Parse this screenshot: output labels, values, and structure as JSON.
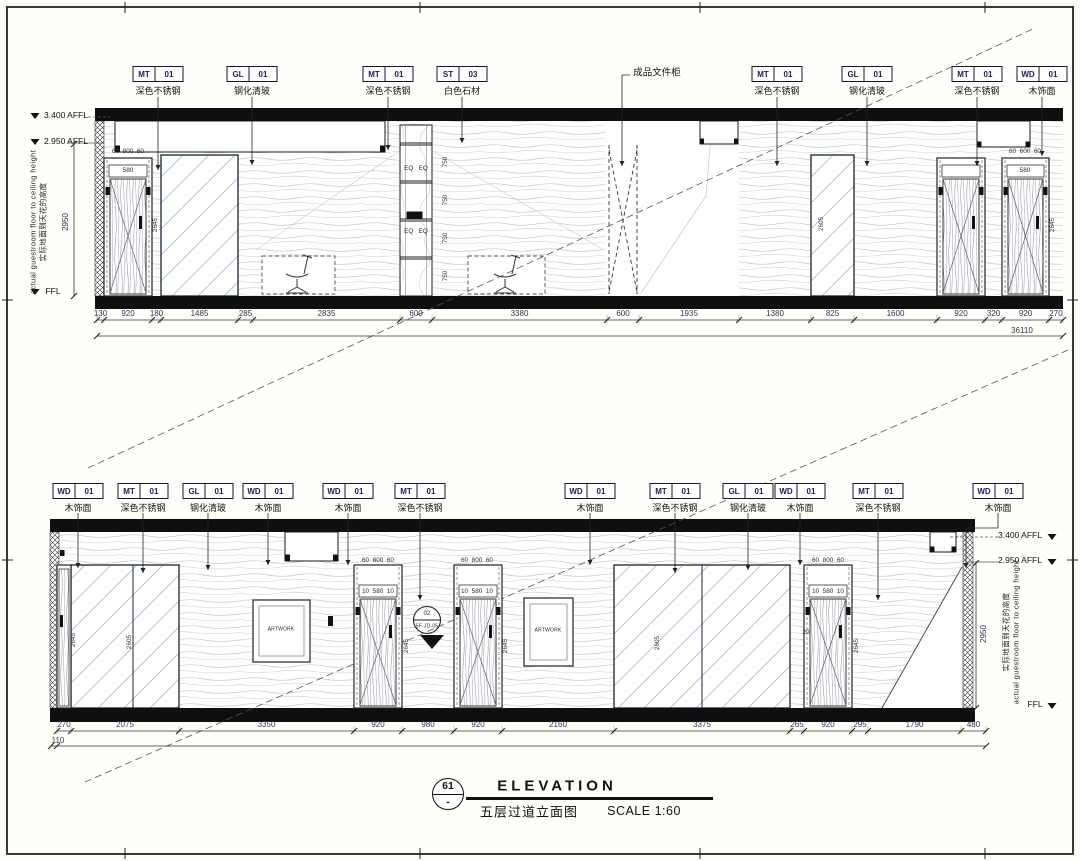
{
  "drawing": {
    "title_block": {
      "detail_number": "61",
      "detail_ref": "-",
      "title": "ELEVATION",
      "name_cn": "五层过道立面图",
      "scale": "SCALE 1:60"
    },
    "levels": {
      "afl_340": "3.400 AFFL",
      "afl_295": "2.950 AFFL",
      "ffl": "FFL",
      "floor_to_ceiling": "2950",
      "note_en": "actual guestroom floor to ceiling height",
      "note_cn": "实际地面到天花的高度"
    },
    "top_elevation": {
      "tags": [
        {
          "code": "MT",
          "num": "01",
          "desc": "深色不锈钢"
        },
        {
          "code": "GL",
          "num": "01",
          "desc": "钢化清玻"
        },
        {
          "code": "MT",
          "num": "01",
          "desc": "深色不锈钢"
        },
        {
          "code": "ST",
          "num": "03",
          "desc": "白色石材"
        },
        {
          "code": "MT",
          "num": "01",
          "desc": "深色不锈钢"
        },
        {
          "code": "GL",
          "num": "01",
          "desc": "钢化清玻"
        },
        {
          "code": "MT",
          "num": "01",
          "desc": "深色不锈钢"
        },
        {
          "code": "WD",
          "num": "01",
          "desc": "木饰面"
        }
      ],
      "cabinet_note": "成品文件柜",
      "dims": [
        "130",
        "920",
        "180",
        "1485",
        "285",
        "2835",
        "600",
        "3380",
        "600",
        "1935",
        "1380",
        "825",
        "1600",
        "920",
        "320",
        "920",
        "270"
      ],
      "overall_dim": "36110",
      "micro_dims": {
        "door_frame": "60  800  60",
        "door_frame_r": "60  600  60",
        "door_leaf": "580",
        "shelf_eq": "EQ   EQ",
        "shelf_h": "750",
        "door_h": "2645",
        "glass_h": "2605"
      }
    },
    "bottom_elevation": {
      "tags": [
        {
          "code": "WD",
          "num": "01",
          "desc": "木饰面"
        },
        {
          "code": "MT",
          "num": "01",
          "desc": "深色不锈钢"
        },
        {
          "code": "GL",
          "num": "01",
          "desc": "钢化清玻"
        },
        {
          "code": "WD",
          "num": "01",
          "desc": "木饰面"
        },
        {
          "code": "WD",
          "num": "01",
          "desc": "木饰面"
        },
        {
          "code": "MT",
          "num": "01",
          "desc": "深色不锈钢"
        },
        {
          "code": "WD",
          "num": "01",
          "desc": "木饰面"
        },
        {
          "code": "MT",
          "num": "01",
          "desc": "深色不锈钢"
        },
        {
          "code": "GL",
          "num": "01",
          "desc": "钢化清玻"
        },
        {
          "code": "WD",
          "num": "01",
          "desc": "木饰面"
        },
        {
          "code": "MT",
          "num": "01",
          "desc": "深色不锈钢"
        },
        {
          "code": "WD",
          "num": "01",
          "desc": "木饰面"
        }
      ],
      "dims": [
        "270",
        "2075",
        "3350",
        "920",
        "980",
        "920",
        "2160",
        "3375",
        "265",
        "920",
        "295",
        "1790",
        "480"
      ],
      "offset_dim": "110",
      "artwork": "ARTWORK",
      "detail_bubble": {
        "top": "02",
        "bottom": "5F-JD-05"
      },
      "micro_dims": {
        "door_frame": "60  800  60",
        "door_leaf": "10  580  10",
        "door_h": "2645",
        "glass_h": "2605",
        "reveal": "20"
      }
    }
  }
}
